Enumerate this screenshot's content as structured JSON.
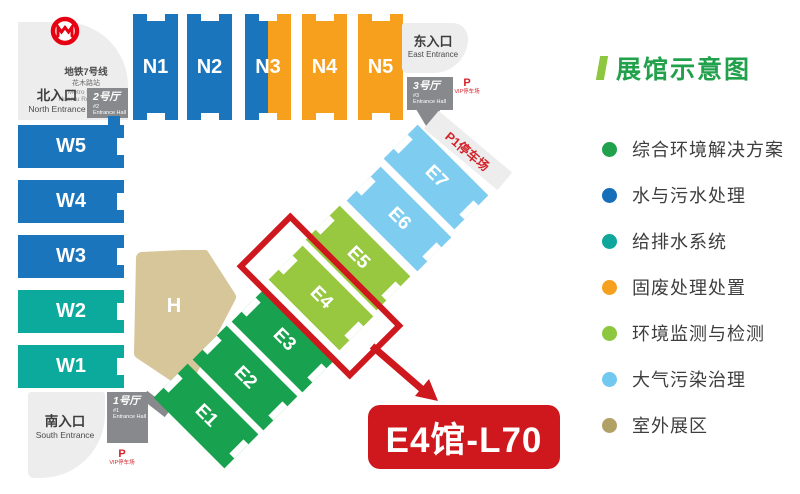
{
  "legend": {
    "title": "展馆示意图",
    "items": [
      {
        "label": "综合环境解决方案",
        "color": "#22A14C"
      },
      {
        "label": "水与污水处理",
        "color": "#166FB8"
      },
      {
        "label": "给排水系统",
        "color": "#0FA79B"
      },
      {
        "label": "固废处理处置",
        "color": "#F5A01E"
      },
      {
        "label": "环境监测与检测",
        "color": "#8DC63F"
      },
      {
        "label": "大气污染治理",
        "color": "#72C9F0"
      },
      {
        "label": "室外展区",
        "color": "#B1A164"
      }
    ]
  },
  "map": {
    "metro": {
      "line_zh": "地铁7号线",
      "station_zh": "花木路站",
      "line_en": "Metro Line 7",
      "station_en": "Huamu Rd. Station"
    },
    "entrances": {
      "north": {
        "zh": "北入口",
        "en": "North Entrance"
      },
      "east": {
        "zh": "东入口",
        "en": "East Entrance"
      },
      "south": {
        "zh": "南入口",
        "en": "South Entrance"
      }
    },
    "entrance_halls": {
      "no1": {
        "zh": "1号厅",
        "num": "#1",
        "en": "Entrance Hall"
      },
      "no2": {
        "zh": "2号厅",
        "num": "#2",
        "en": "Entrance Hall"
      },
      "no3": {
        "zh": "3号厅",
        "num": "#3",
        "en": "Entrance Hall"
      }
    },
    "parking": {
      "vip_top": {
        "p": "P",
        "label": "VIP停车场"
      },
      "vip_bottom": {
        "p": "P",
        "label": "VIP停车场"
      },
      "p1": {
        "label": "P1停车场"
      }
    },
    "halls": {
      "n1": "N1",
      "n2": "N2",
      "n3": "N3",
      "n4": "N4",
      "n5": "N5",
      "w1": "W1",
      "w2": "W2",
      "w3": "W3",
      "w4": "W4",
      "w5": "W5",
      "e1": "E1",
      "e2": "E2",
      "e3": "E3",
      "e4": "E4",
      "e5": "E5",
      "e6": "E6",
      "e7": "E7",
      "h": "H"
    },
    "callout": {
      "label": "E4馆-L70"
    }
  },
  "colors": {
    "water_blue": "#1B75BC",
    "solid_waste_orange": "#F6A01E",
    "drainage_teal": "#0CA99D",
    "solution_green": "#18A14E",
    "monitoring_light_green": "#97C83F",
    "air_light_blue": "#7ECDF1",
    "outdoor_tan": "#D8C69B",
    "highlight_red": "#CE181E",
    "parking_red": "#D2232A",
    "metro_red": "#E60012",
    "entrance_hall_gray": "#87898C",
    "area_light_gray": "#EDEDEE",
    "legend_title_green": "#21A14B",
    "legend_title_bar_green": "#8DC63F",
    "text_dark": "#3E3E3E"
  }
}
